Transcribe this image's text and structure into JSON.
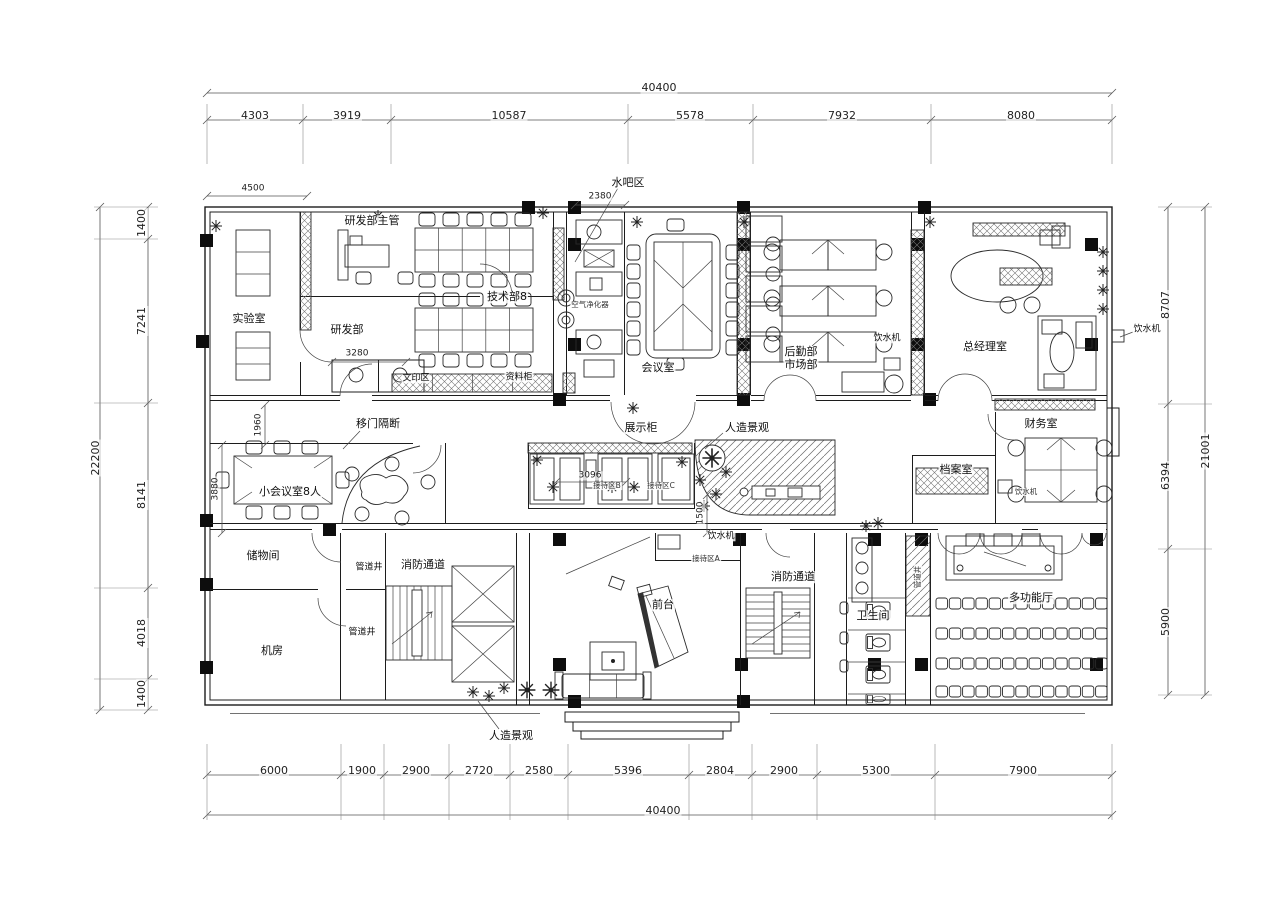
{
  "rooms": {
    "lab": "实验室",
    "rd_supervisor": "研发部主管",
    "rd_dept": "研发部",
    "tech_dept": "技术部8",
    "water_bar": "水吧区",
    "meeting_room": "会议室",
    "logistics_dept": "后勤部",
    "marketing_dept": "市场部",
    "gm_office": "总经理室",
    "finance_room": "财务室",
    "archive_room": "档案室",
    "small_meeting": "小会议室8人",
    "storage_room": "储物间",
    "pipe_shaft": "管道井",
    "fire_corridor": "消防通道",
    "machine_room": "机房",
    "front_desk": "前台",
    "restroom": "卫生间",
    "multi_hall": "多功能厅",
    "print_area": "文印区",
    "file_cabinet": "资料柜",
    "display_cabinet": "展示柜"
  },
  "features": {
    "sliding_partition": "移门隔断",
    "landscape": "人造景观",
    "water_dispenser": "饮水机",
    "air_purifier": "空气净化器",
    "reception_a": "接待区A",
    "reception_b": "接待区B",
    "reception_c": "接待区C"
  },
  "dimensions": {
    "total_width": "40400",
    "total_height_left": "22200",
    "total_height_right": "21001",
    "top_segments": [
      "4303",
      "3919",
      "10587",
      "5578",
      "7932",
      "8080"
    ],
    "bottom_segments": [
      "6000",
      "1900",
      "2900",
      "2720",
      "2580",
      "5396",
      "2804",
      "2900",
      "5300",
      "7900"
    ],
    "left_segments": [
      "1400",
      "7241",
      "8141",
      "4018",
      "1400"
    ],
    "right_segments": [
      "8707",
      "6394",
      "5900"
    ],
    "local": {
      "lab_width": "4500",
      "water_bar_width": "2380",
      "wc_width": "3280",
      "corridor_offset": "1960",
      "small_meeting_depth": "3880",
      "display_width": "3096",
      "lobby_offset": "1500"
    }
  }
}
